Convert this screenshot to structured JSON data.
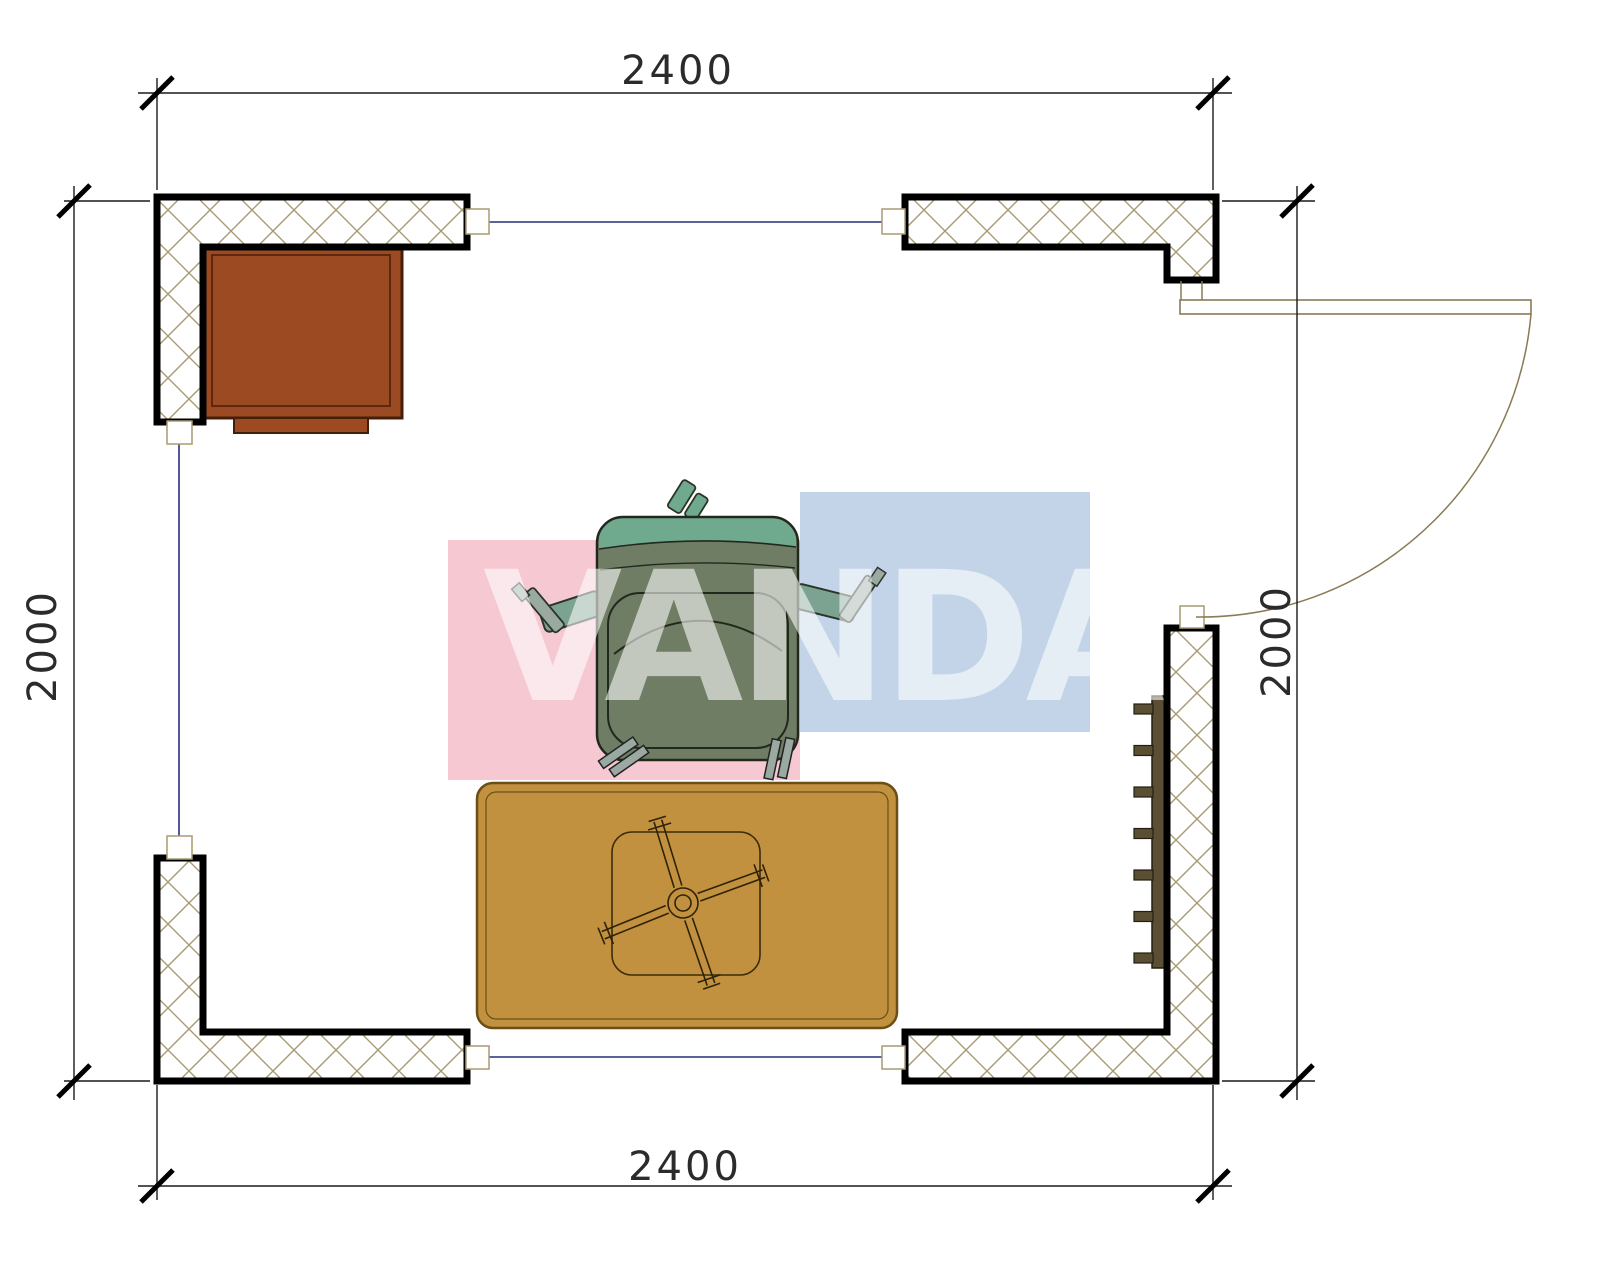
{
  "plan": {
    "dimension_labels": {
      "top": "2400",
      "bottom": "2400",
      "left": "2000",
      "right": "2000"
    },
    "watermark": {
      "text": "VANDA",
      "pink": "#f5c3cd",
      "blue": "#bdcfe7",
      "letter_color": "#ffffff"
    },
    "colors": {
      "wall_border": "#000000",
      "wall_hatch": "#a89a72",
      "window_line": "#24307a",
      "door_line": "#8a7a55",
      "dim_line": "#1a1a1a",
      "cabinet": "#9c4a22",
      "cabinet_border": "#431f0a",
      "rug": "#c2913f",
      "rug_border": "#6b4f17",
      "table_line": "#3a2c0a",
      "chair_body": "#6f7d64",
      "chair_back": "#70aa8e",
      "chair_arm": "#7ca391",
      "chair_metal": "#9aa9a2",
      "radiator": "#5a4f33"
    }
  }
}
